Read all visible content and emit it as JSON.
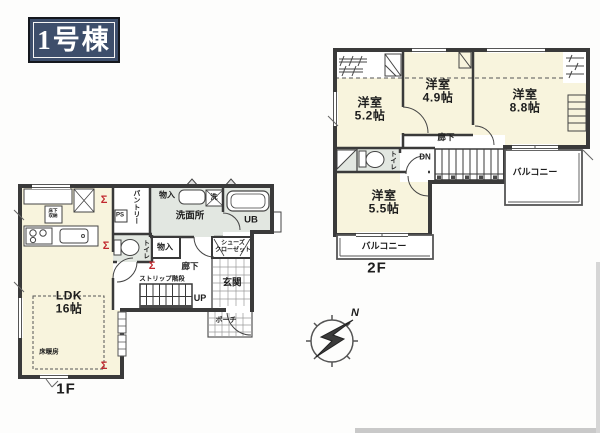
{
  "badge": {
    "label": "1号棟"
  },
  "floor1": {
    "floor_label": "1F",
    "ldk": {
      "name": "LDK",
      "size": "16帖"
    },
    "floor_heating": "床暖房",
    "pantry": "パントリー",
    "ps": "PS",
    "storage_top": "物入",
    "storage_mid": "物入",
    "washroom": "洗面所",
    "washer": "洗",
    "unit_bath": "UB",
    "toilet": "トイレ",
    "corridor": "廊下",
    "stairs": "ストリップ階段",
    "up": "UP",
    "shoe_closet_line1": "シューズ",
    "shoe_closet_line2": "クローゼット",
    "entrance": "玄関",
    "porch": "ポーチ",
    "underfloor_line1": "床下",
    "underfloor_line2": "収納",
    "shutter_mark": "Σ"
  },
  "floor2": {
    "floor_label": "2F",
    "room_52": {
      "name": "洋室",
      "size": "5.2帖"
    },
    "room_49": {
      "name": "洋室",
      "size": "4.9帖"
    },
    "room_88": {
      "name": "洋室",
      "size": "8.8帖"
    },
    "room_55": {
      "name": "洋室",
      "size": "5.5帖"
    },
    "corridor": "廊下",
    "dn": "DN",
    "toilet": "トイレ",
    "balcony_right": "バルコニー",
    "balcony_bottom": "バルコニー"
  },
  "compass": {
    "north": "N"
  },
  "colors": {
    "wall": "#3a3a3a",
    "room_cream": "#f8f4dd",
    "wet_area_gray": "#e2e7e1",
    "accent_red": "#c1272d",
    "badge_navy": "#3d4e6b"
  }
}
